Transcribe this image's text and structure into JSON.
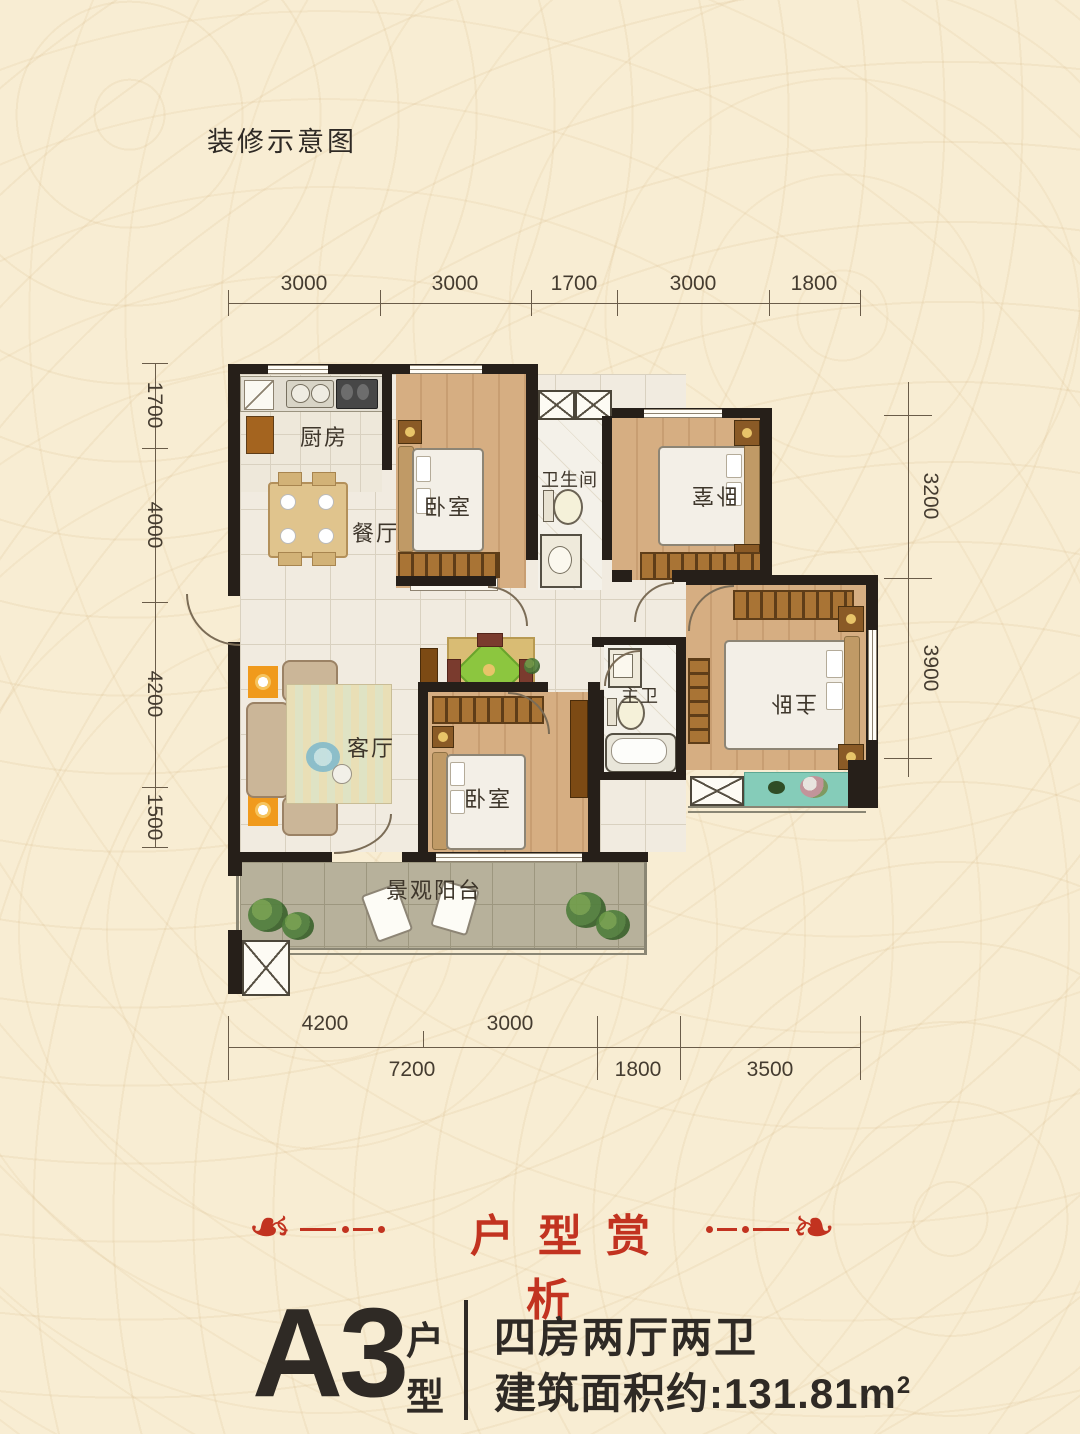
{
  "page": {
    "doc_label": "装修示意图"
  },
  "colors": {
    "background": "#f8edd3",
    "pattern": "#ecd9b4",
    "accent_red": "#c23320",
    "text_dark": "#2f2a25",
    "dim_text": "#453c30",
    "wall": "#261f19",
    "wood_floor": "#d6ae82",
    "tile_floor": "#f1ebe0",
    "balcony_tile": "#b7b19b",
    "teal_balcony": "#85ccb9",
    "accent_orange": "#f09a1c"
  },
  "plan": {
    "rooms": {
      "kitchen": "厨房",
      "dining": "餐厅",
      "bedroom": "卧室",
      "bathroom": "卫生间",
      "master_bath": "主卫",
      "master_bedroom": "主卧",
      "living": "客厅",
      "balcony": "景观阳台"
    },
    "dims": {
      "top": [
        "3000",
        "3000",
        "1700",
        "3000",
        "1800"
      ],
      "left": [
        "1700",
        "4000",
        "4200",
        "1500"
      ],
      "right": [
        "3200",
        "3900"
      ],
      "bottom_upper": [
        "4200",
        "3000"
      ],
      "bottom_lower": [
        "7200",
        "1800",
        "3500"
      ]
    }
  },
  "banner": {
    "title": "户型赏析",
    "ornament": "❧"
  },
  "unit": {
    "code": "A3",
    "type_top": "户",
    "type_bottom": "型",
    "layout": "四房两厅两卫",
    "area_label": "建筑面积约:",
    "area_value": "131.81m",
    "area_sup": "2"
  }
}
